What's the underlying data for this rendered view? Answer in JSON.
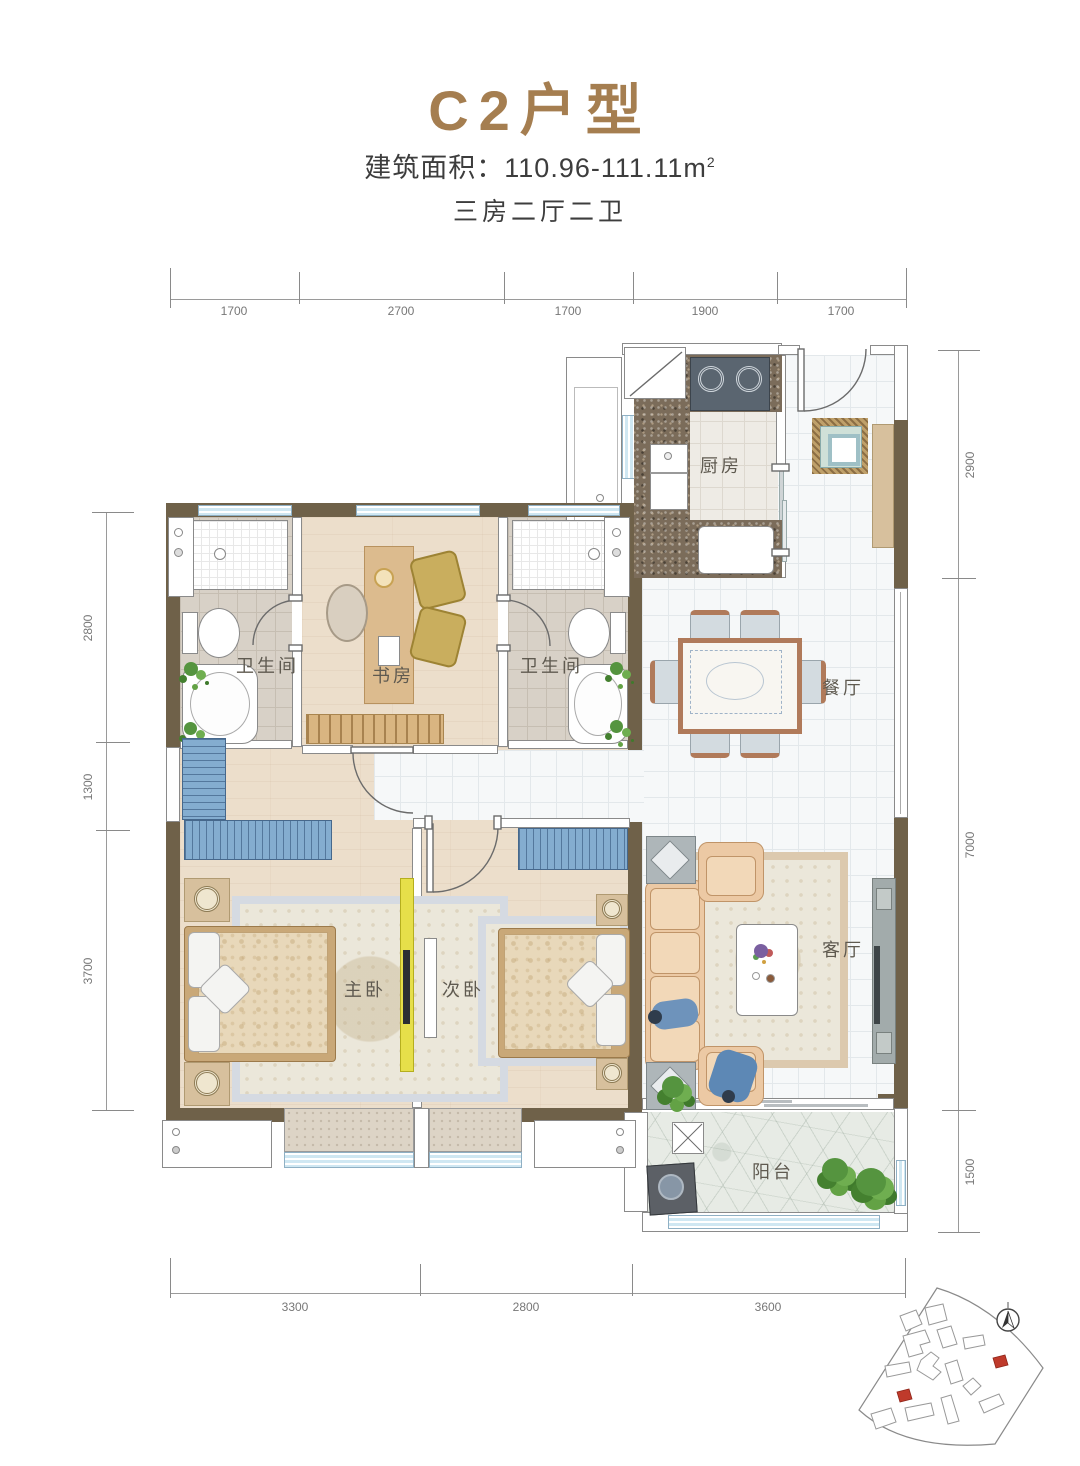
{
  "header": {
    "title": "C2户型",
    "area_label": "建筑面积：",
    "area_value": "110.96-111.11",
    "area_unit_base": "m",
    "area_unit_exp": "2",
    "layout_text": "三房二厅二卫"
  },
  "rooms": {
    "kitchen": {
      "label": "厨房"
    },
    "bath_left": {
      "label": "卫生间"
    },
    "study": {
      "label": "书房"
    },
    "bath_right": {
      "label": "卫生间"
    },
    "dining": {
      "label": "餐厅"
    },
    "master_bedroom": {
      "label": "主卧"
    },
    "second_bedroom": {
      "label": "次卧"
    },
    "living": {
      "label": "客厅"
    },
    "balcony": {
      "label": "阳台"
    }
  },
  "dimensions": {
    "top": [
      "1700",
      "2700",
      "1700",
      "1900",
      "1700"
    ],
    "bottom": [
      "3300",
      "2800",
      "3600"
    ],
    "left": [
      "2800",
      "1300",
      "3700"
    ],
    "right": [
      "2900",
      "7000",
      "1500"
    ]
  },
  "colors": {
    "wall": "#6f6149",
    "title_brown": "#a57e50",
    "window_blue": "#cfe7f2",
    "highlight_red": "#b03a2e"
  },
  "site_map": {
    "highlighted_building_count": 2
  }
}
